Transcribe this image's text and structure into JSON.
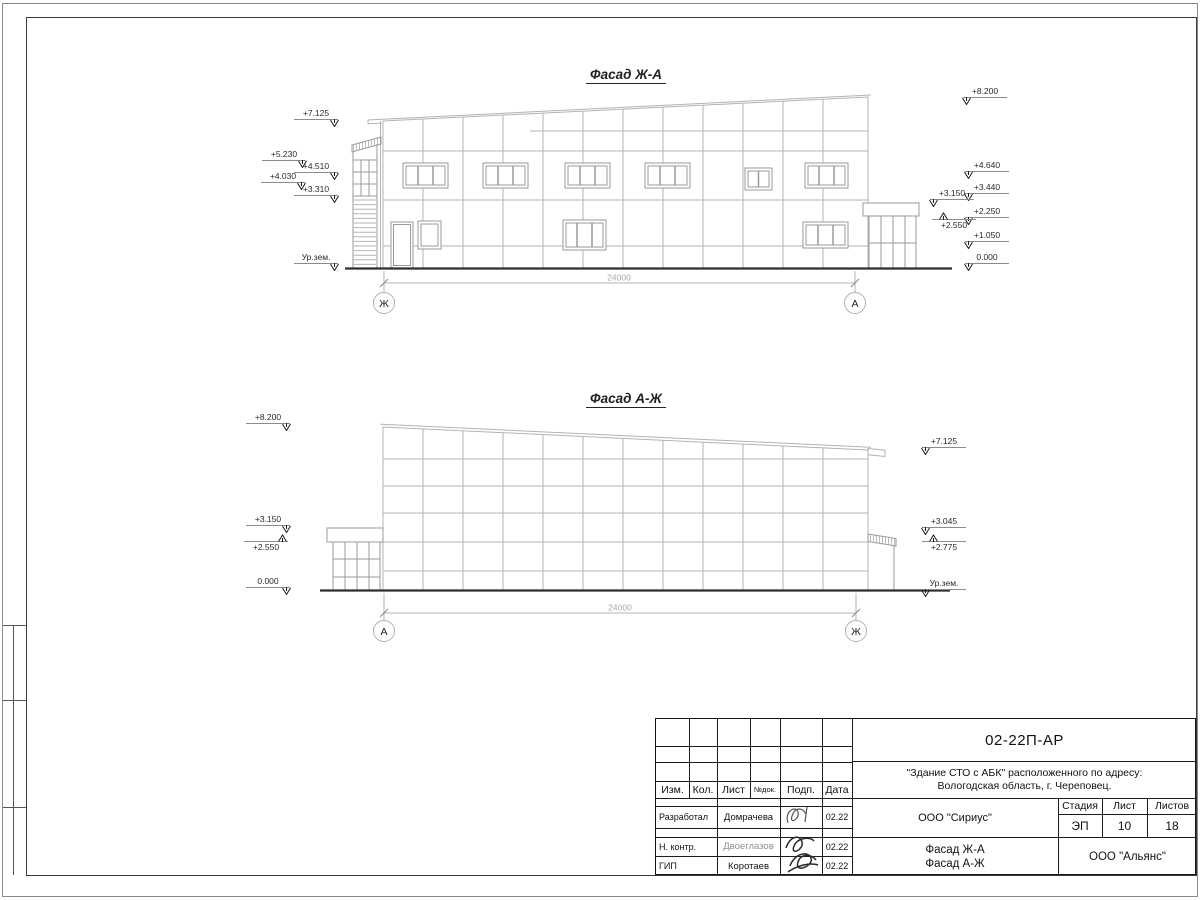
{
  "f1": {
    "title": "Фасад Ж-А",
    "dim": "24000",
    "axisL": "Ж",
    "axisR": "А",
    "ml": [
      "+7.125",
      "+5.230",
      "+4.510",
      "+4.030",
      "+3.310",
      "Ур.зем."
    ],
    "mr": [
      "+8.200",
      "+4.640",
      "+3.440",
      "+3.150",
      "+2.250",
      "+2.550",
      "+1.050",
      "0.000"
    ]
  },
  "f2": {
    "title": "Фасад А-Ж",
    "dim": "24000",
    "axisL": "А",
    "axisR": "Ж",
    "ml": [
      "+8.200",
      "+3.150",
      "+2.550",
      "0.000"
    ],
    "mr": [
      "+7.125",
      "+3.045",
      "+2.775",
      "Ур.зем."
    ]
  },
  "stamp": {
    "doc": "02-22П-АР",
    "addr1": "\"Здание СТО с АБК\" расположенного по адресу:",
    "addr2": "Вологодская область, г. Череповец.",
    "h": [
      "Изм.",
      "Кол.",
      "Лист",
      "№док.",
      "Подп.",
      "Дата"
    ],
    "roles": [
      {
        "r": "Разработал",
        "n": "Домрачева",
        "d": "02.22"
      },
      {
        "r": "Н. контр.",
        "n": "Двоеглазов",
        "d": "02.22"
      },
      {
        "r": "ГИП",
        "n": "Коротаев",
        "d": "02.22"
      }
    ],
    "org": "ООО \"Сириус\"",
    "stage_l": "Стадия",
    "sheet_l": "Лист",
    "sheets_l": "Листов",
    "stage": "ЭП",
    "sheet": "10",
    "sheets": "18",
    "subj1": "Фасад Ж-А",
    "subj2": "Фасад А-Ж",
    "company": "ООО \"Альянс\""
  }
}
